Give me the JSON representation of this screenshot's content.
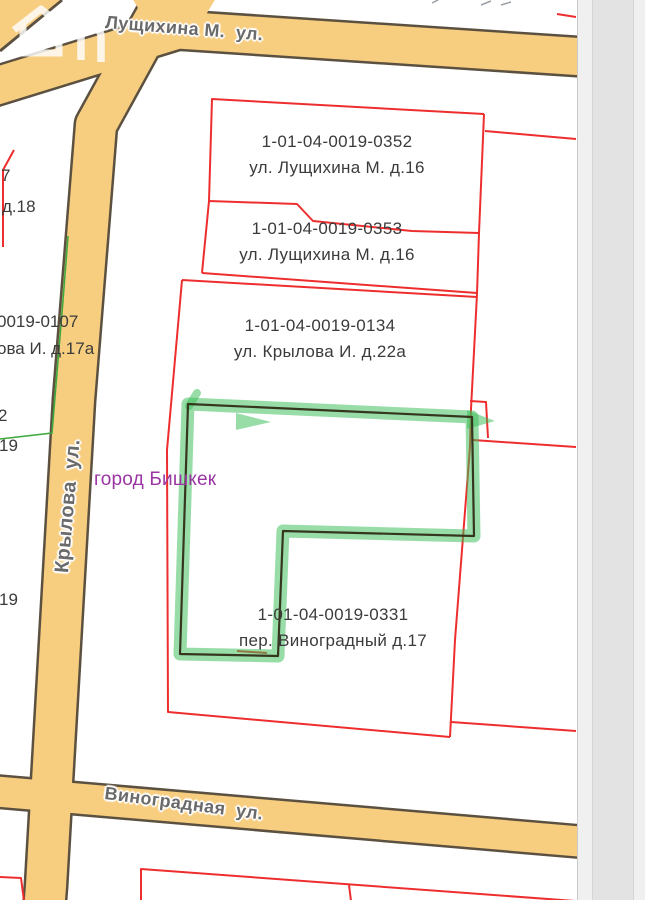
{
  "map": {
    "city_label": "город Бишкек",
    "streets": {
      "top": "Лущихина М.  ул.",
      "left": "Крылова  ул.",
      "bottom": "Виноградная  ул."
    },
    "parcels": [
      {
        "id": "1-01-04-0019-0352",
        "address": "ул. Лущихина М. д.16"
      },
      {
        "id": "1-01-04-0019-0353",
        "address": "ул. Лущихина М. д.16"
      },
      {
        "id": "1-01-04-0019-0134",
        "address": "ул. Крылова И. д.22а"
      },
      {
        "id": "1-01-04-0019-0331",
        "address": "пер. Виноградный д.17"
      }
    ],
    "partial_labels": {
      "a": "7",
      "b": "д.18",
      "c": "0019-0107",
      "d": "ова И. д.17а",
      "e": "2",
      "f": "19",
      "g": "19"
    },
    "colors": {
      "parcel_outline": "#ee2e2e",
      "selection_highlight": "#3cbb58",
      "selection_line": "#35361e",
      "street_fill": "#f7ce80",
      "street_border": "#5c5140",
      "label_text": "#3b3b3b",
      "street_text": "#6a6a6a",
      "city_text": "#9a35a3"
    }
  }
}
